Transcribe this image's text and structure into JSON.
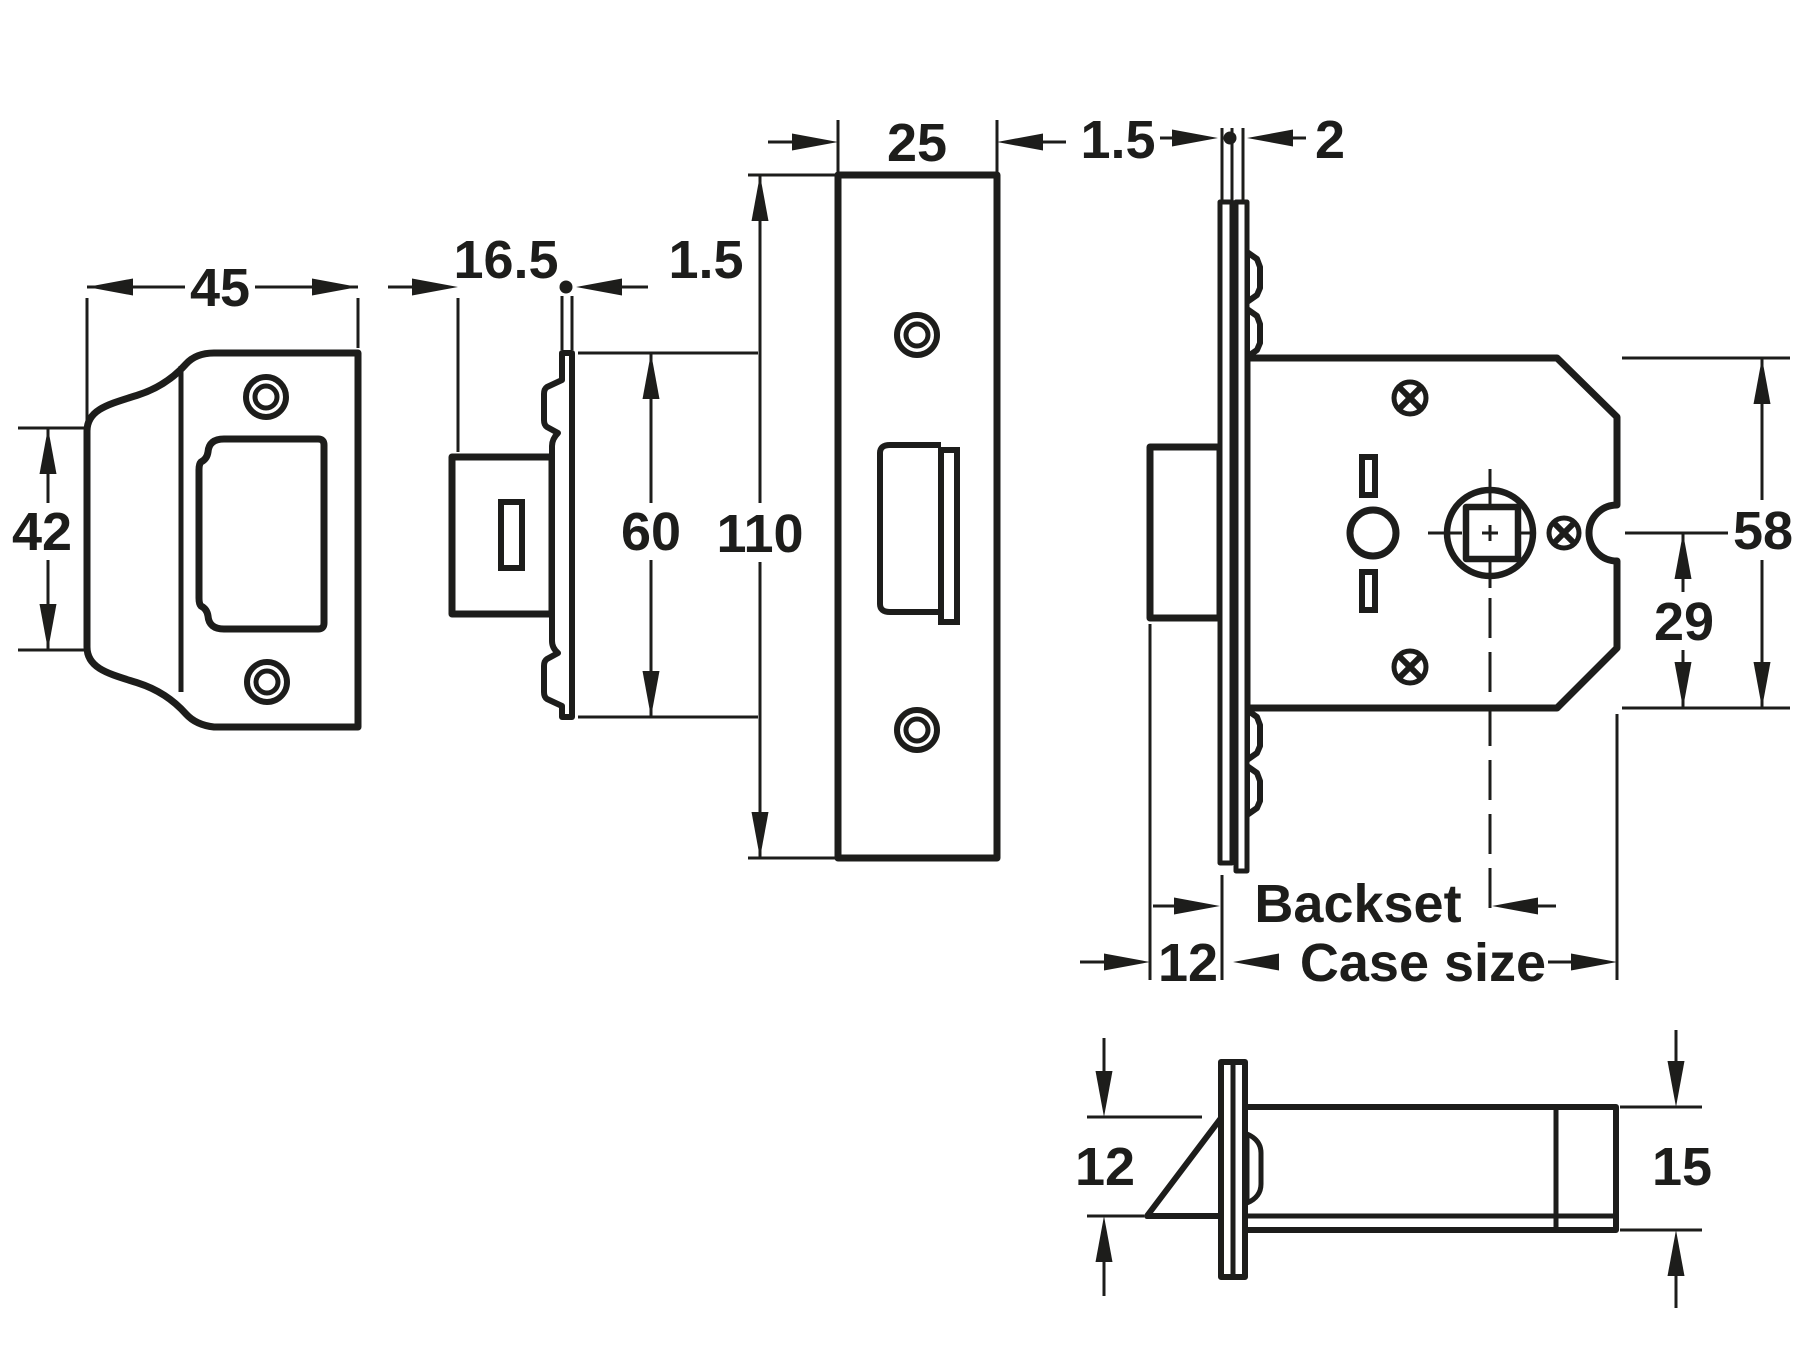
{
  "page": {
    "background": "#ffffff",
    "line_color": "#1d1d1b"
  },
  "drawing": {
    "description": "Mortice latch technical drawing with five orthographic views and dimensions",
    "views": {
      "strike_plate_front": {
        "name": "Strike plate - front view",
        "dims": {
          "width": "45",
          "box_height": "42"
        }
      },
      "strike_plate_side": {
        "name": "Strike plate - side view",
        "dims": {
          "depth": "16.5",
          "plate_thickness": "1.5",
          "height": "60"
        }
      },
      "forend_front": {
        "name": "Forend faceplate - front view",
        "dims": {
          "width": "25",
          "height": "110"
        }
      },
      "case_side": {
        "name": "Lock case - side view",
        "dims": {
          "faceplate_thickness": "1.5",
          "cover_plate_thickness": "2",
          "case_height": "58",
          "follower_to_bottom": "29",
          "backset_label": "Backset",
          "bolt_projection": "12",
          "case_size_label": "Case size"
        }
      },
      "latch_bolt_bottom": {
        "name": "Latch bolt - bottom view",
        "dims": {
          "bolt_height": "12",
          "case_depth": "15"
        }
      }
    }
  }
}
